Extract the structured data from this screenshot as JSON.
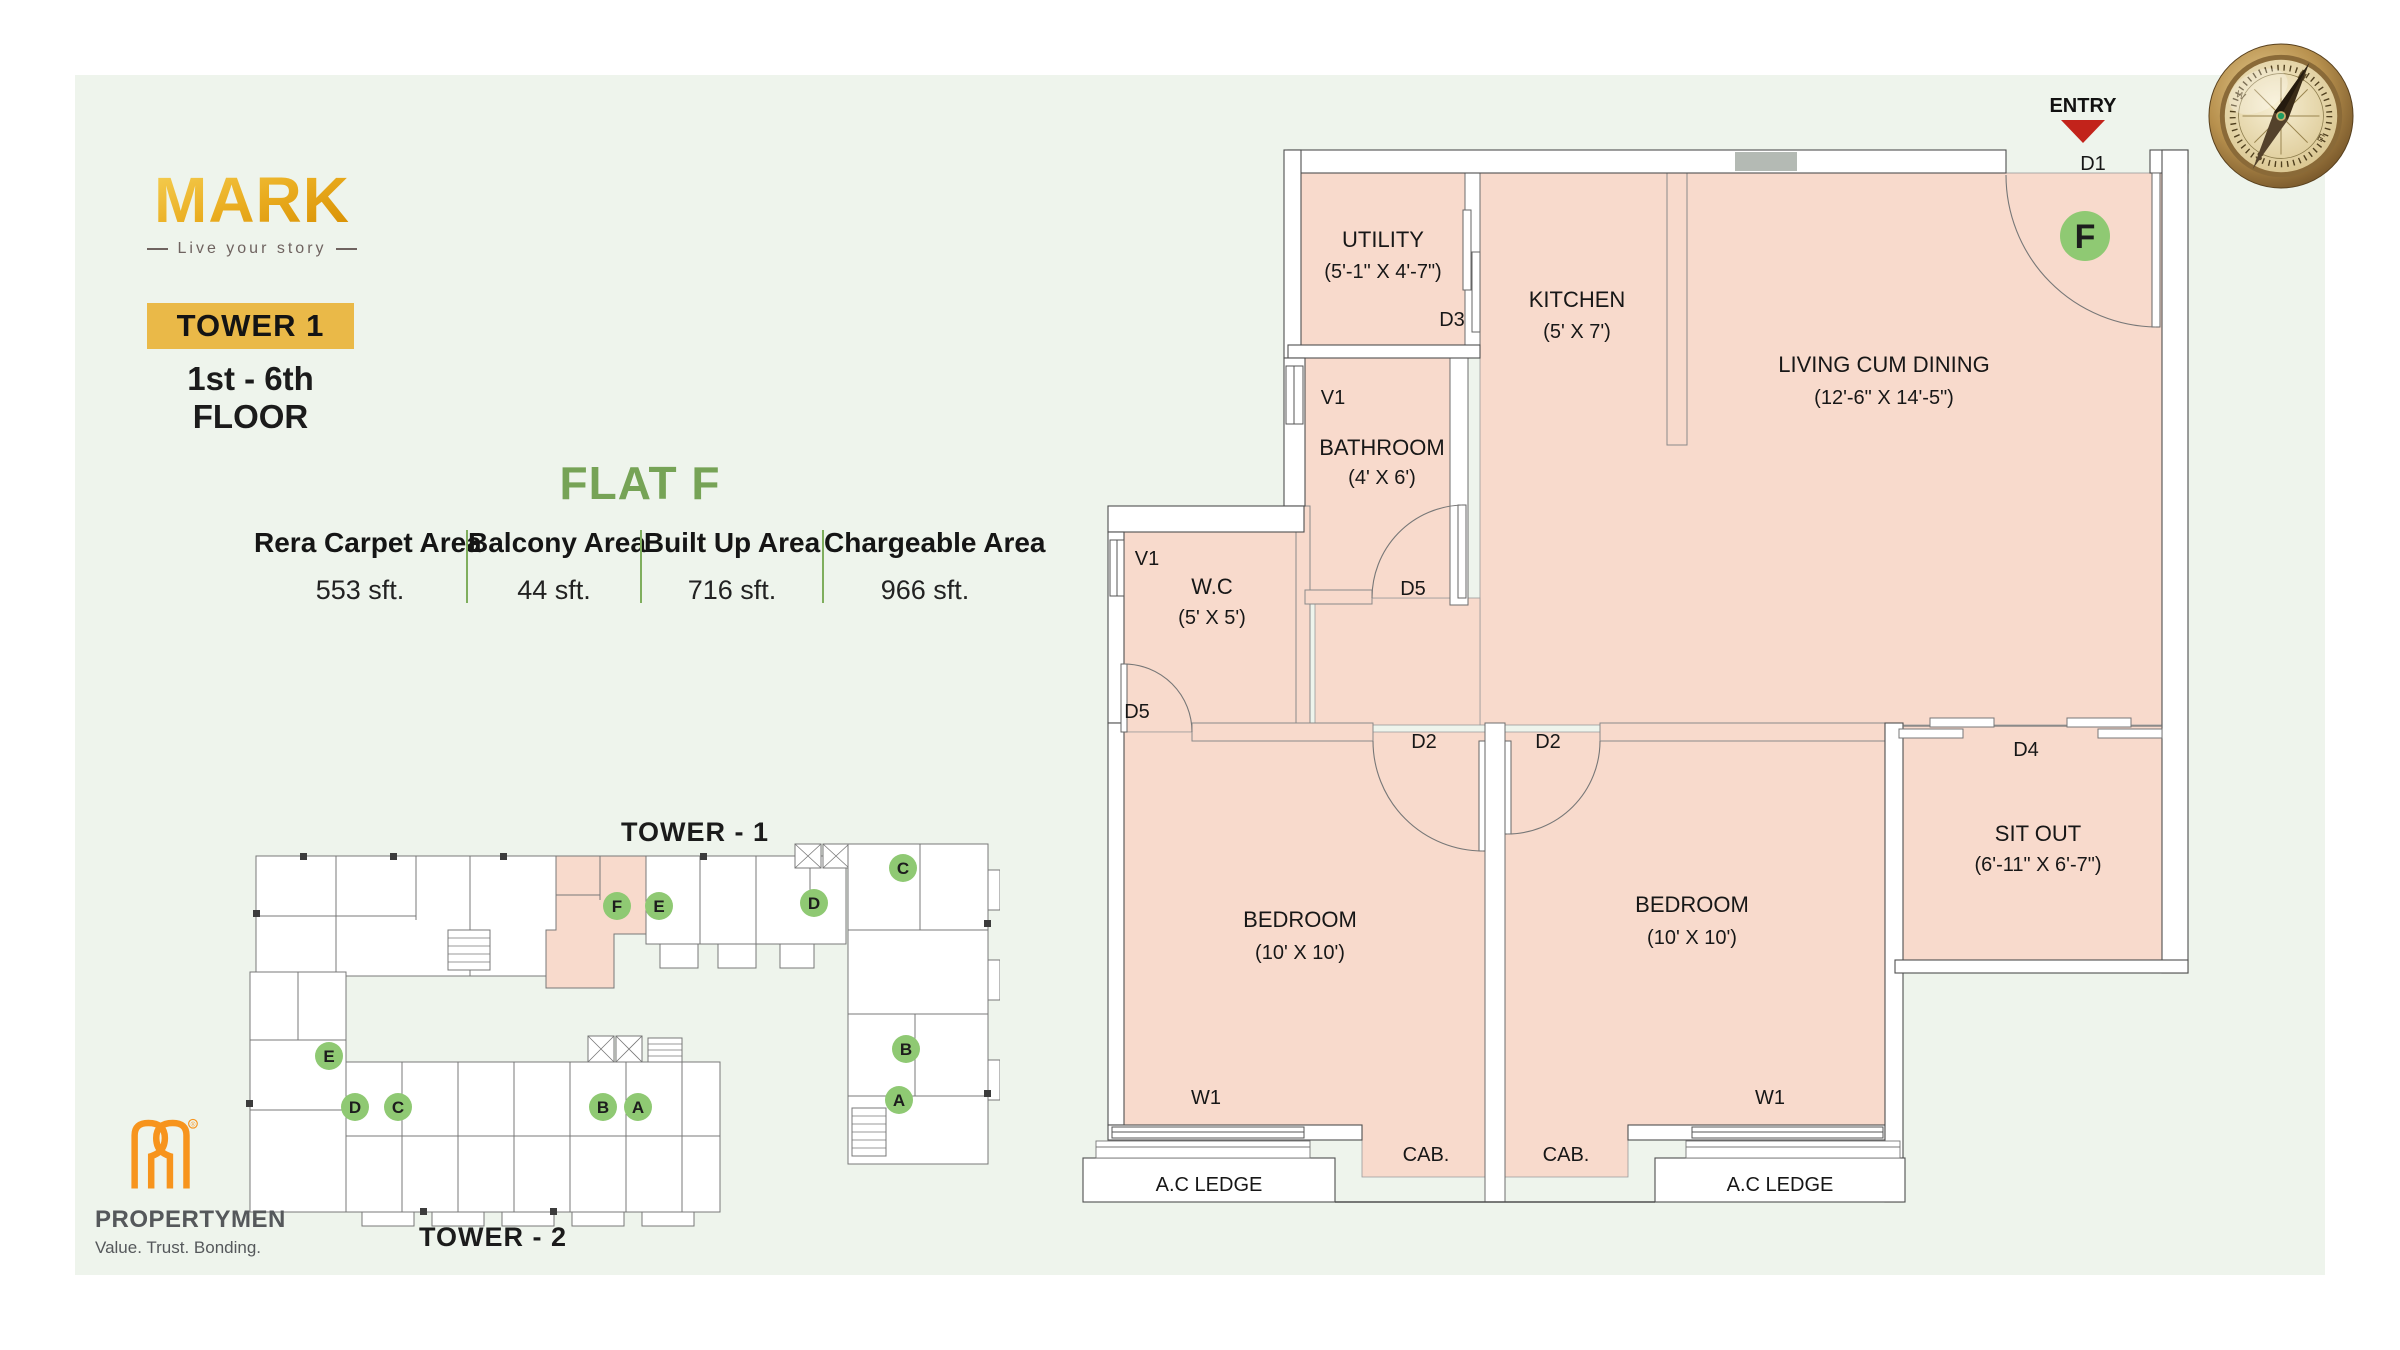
{
  "header": {
    "logo": "MARK",
    "logo_tagline": "Live your story",
    "tower_badge": "TOWER 1",
    "floor_range": "1st - 6th FLOOR"
  },
  "flat": {
    "title": "FLAT F",
    "areas": [
      {
        "label": "Rera Carpet Area",
        "value": "553 sft."
      },
      {
        "label": "Balcony Area",
        "value": "44 sft."
      },
      {
        "label": "Built Up Area",
        "value": "716 sft."
      },
      {
        "label": "Chargeable Area",
        "value": "966 sft."
      }
    ]
  },
  "plan": {
    "entry": "ENTRY",
    "flat_letter": "F",
    "rooms": {
      "utility": {
        "name": "UTILITY",
        "dims": "(5'-1\" X 4'-7\")"
      },
      "kitchen": {
        "name": "KITCHEN",
        "dims": "(5' X 7')"
      },
      "living": {
        "name": "LIVING CUM DINING",
        "dims": "(12'-6\" X 14'-5\")"
      },
      "bathroom": {
        "name": "BATHROOM",
        "dims": "(4' X 6')"
      },
      "wc": {
        "name": "W.C",
        "dims": "(5' X 5')"
      },
      "bedroom": {
        "name": "BEDROOM",
        "dims": "(10' X 10')"
      },
      "sitout": {
        "name": "SIT OUT",
        "dims": "(6'-11\" X 6'-7\")"
      }
    },
    "codes": {
      "d1": "D1",
      "d2": "D2",
      "d3": "D3",
      "d4": "D4",
      "d5": "D5",
      "v1": "V1",
      "w1": "W1",
      "cab": "CAB.",
      "ac_ledge": "A.C LEDGE"
    }
  },
  "key_plan": {
    "tower1": "TOWER - 1",
    "tower2": "TOWER - 2",
    "badges": {
      "a": "A",
      "b": "B",
      "c": "C",
      "d": "D",
      "e": "E",
      "f": "F"
    }
  },
  "footer": {
    "company": "PROPERTYMEN",
    "tagline": "Value. Trust. Bonding.",
    "registered": "®"
  },
  "compass": {
    "n": "N",
    "e": "E",
    "s": "S",
    "w": "W"
  },
  "colors": {
    "panel_green": "#EEF4EC",
    "room_pink": "#F8DACC",
    "accent_gold": "#EAB948",
    "heading_green": "#76A356",
    "badge_green": "#8FC973",
    "entry_red": "#C2231B",
    "logo_orange": "#F7941D"
  }
}
